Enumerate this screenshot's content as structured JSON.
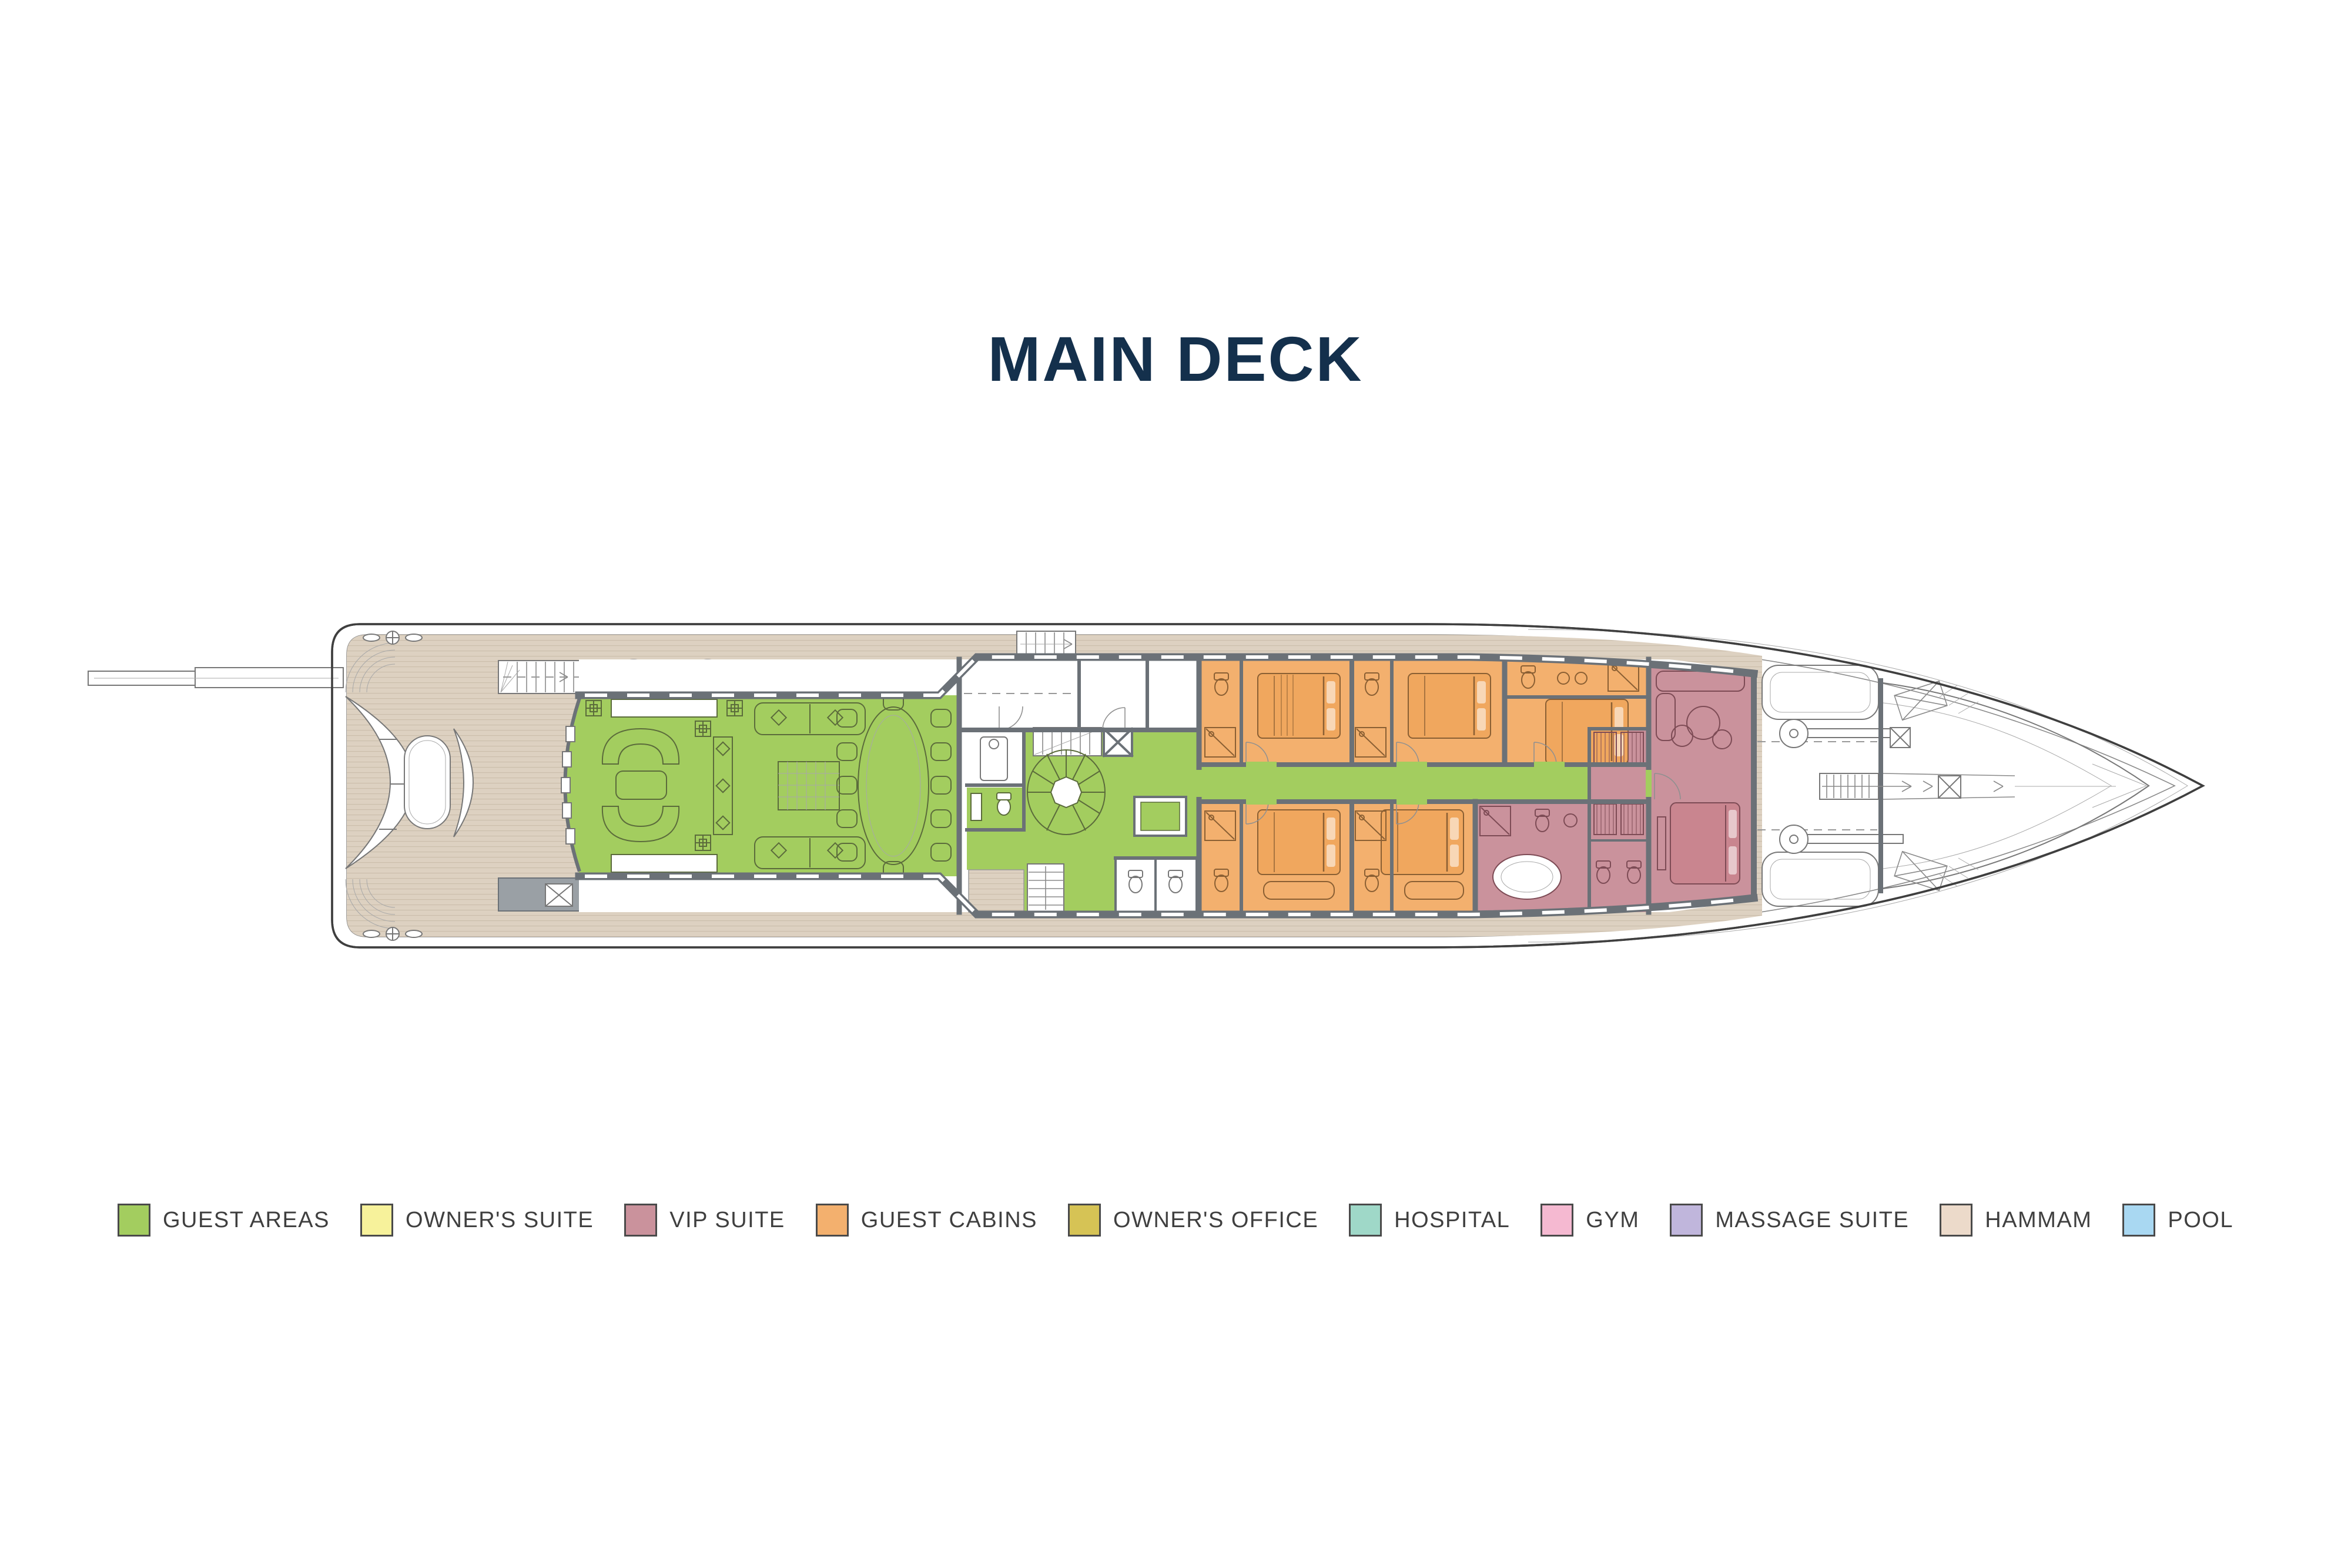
{
  "title": {
    "text": "MAIN DECK"
  },
  "legend": {
    "items": [
      {
        "label": "GUEST AREAS",
        "color": "#a3cd5f"
      },
      {
        "label": "OWNER'S SUITE",
        "color": "#f7f29b"
      },
      {
        "label": "VIP SUITE",
        "color": "#ca929c"
      },
      {
        "label": "GUEST CABINS",
        "color": "#f3b06e"
      },
      {
        "label": "OWNER'S OFFICE",
        "color": "#d6c355"
      },
      {
        "label": "HOSPITAL",
        "color": "#9fd8c8"
      },
      {
        "label": "GYM",
        "color": "#f5b9d1"
      },
      {
        "label": "MASSAGE SUITE",
        "color": "#c0b6dc"
      },
      {
        "label": "HAMMAM",
        "color": "#ecdaca"
      },
      {
        "label": "POOL",
        "color": "#a9d8f2"
      }
    ]
  },
  "palette": {
    "background": "#ffffff",
    "title_color": "#14304c",
    "legend_text": "#3f3f3f",
    "swatch_border": "#4a4a4a",
    "deck_teak": "#ddd1c1",
    "plank_line": "#cabdaa",
    "walls": "#6b7177",
    "hull_outline": "#3f3f3f",
    "guest_areas": "#a3cd5f",
    "guest_cabins": "#f3b06e",
    "vip_suite": "#ca929c",
    "cabin_furniture": "#8a5f33",
    "vip_furniture": "#7d4b55",
    "salon_furniture": "#5b6b3b",
    "deck_furniture": "#777777",
    "bed_orange": "#f0a75e",
    "bed_rose": "#c9858f"
  }
}
